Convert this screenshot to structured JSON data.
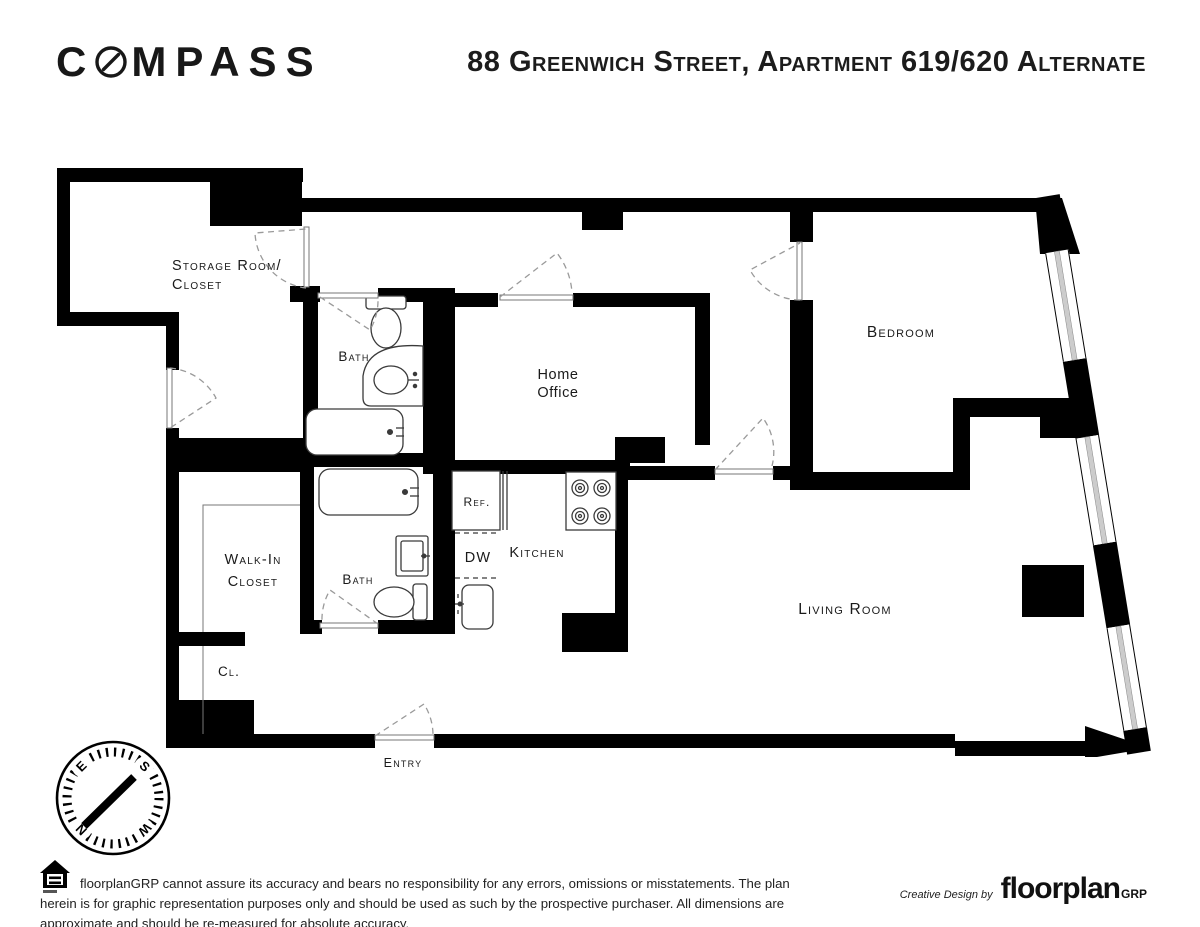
{
  "header": {
    "logo_prefix": "C",
    "logo_suffix": "MPASS",
    "title": "88 Greenwich Street, Apartment 619/620 Alternate"
  },
  "plan": {
    "labels": {
      "storage_line1": "Storage Room/",
      "storage_line2": "Closet",
      "bath_upper": "Bath",
      "home_office_line1": "Home",
      "home_office_line2": "Office",
      "bedroom": "Bedroom",
      "walk_in_line1": "Walk-In",
      "walk_in_line2": "Closet",
      "bath_lower": "Bath",
      "fridge": "Ref.",
      "dishwasher": "DW",
      "kitchen": "Kitchen",
      "living_room": "Living Room",
      "closet_small": "Cl.",
      "entry": "Entry"
    },
    "compass_rose": {
      "north": "N",
      "east": "E",
      "south": "S",
      "west": "W"
    },
    "colors": {
      "wall": "#000000",
      "window_glass": "#cccccc",
      "door_arc": "#9a9a9a"
    }
  },
  "footer": {
    "disclaimer": "floorplanGRP cannot assure its accuracy and bears no responsibility for any errors, omissions or misstatements. The plan herein is for graphic representation purposes only and should be used as such by the prospective purchaser. All dimensions are approximate and should be re-measured for absolute accuracy.",
    "credit_prefix": "Creative Design by",
    "credit_brand": "floorplan",
    "credit_brand_suffix": "GRP"
  }
}
